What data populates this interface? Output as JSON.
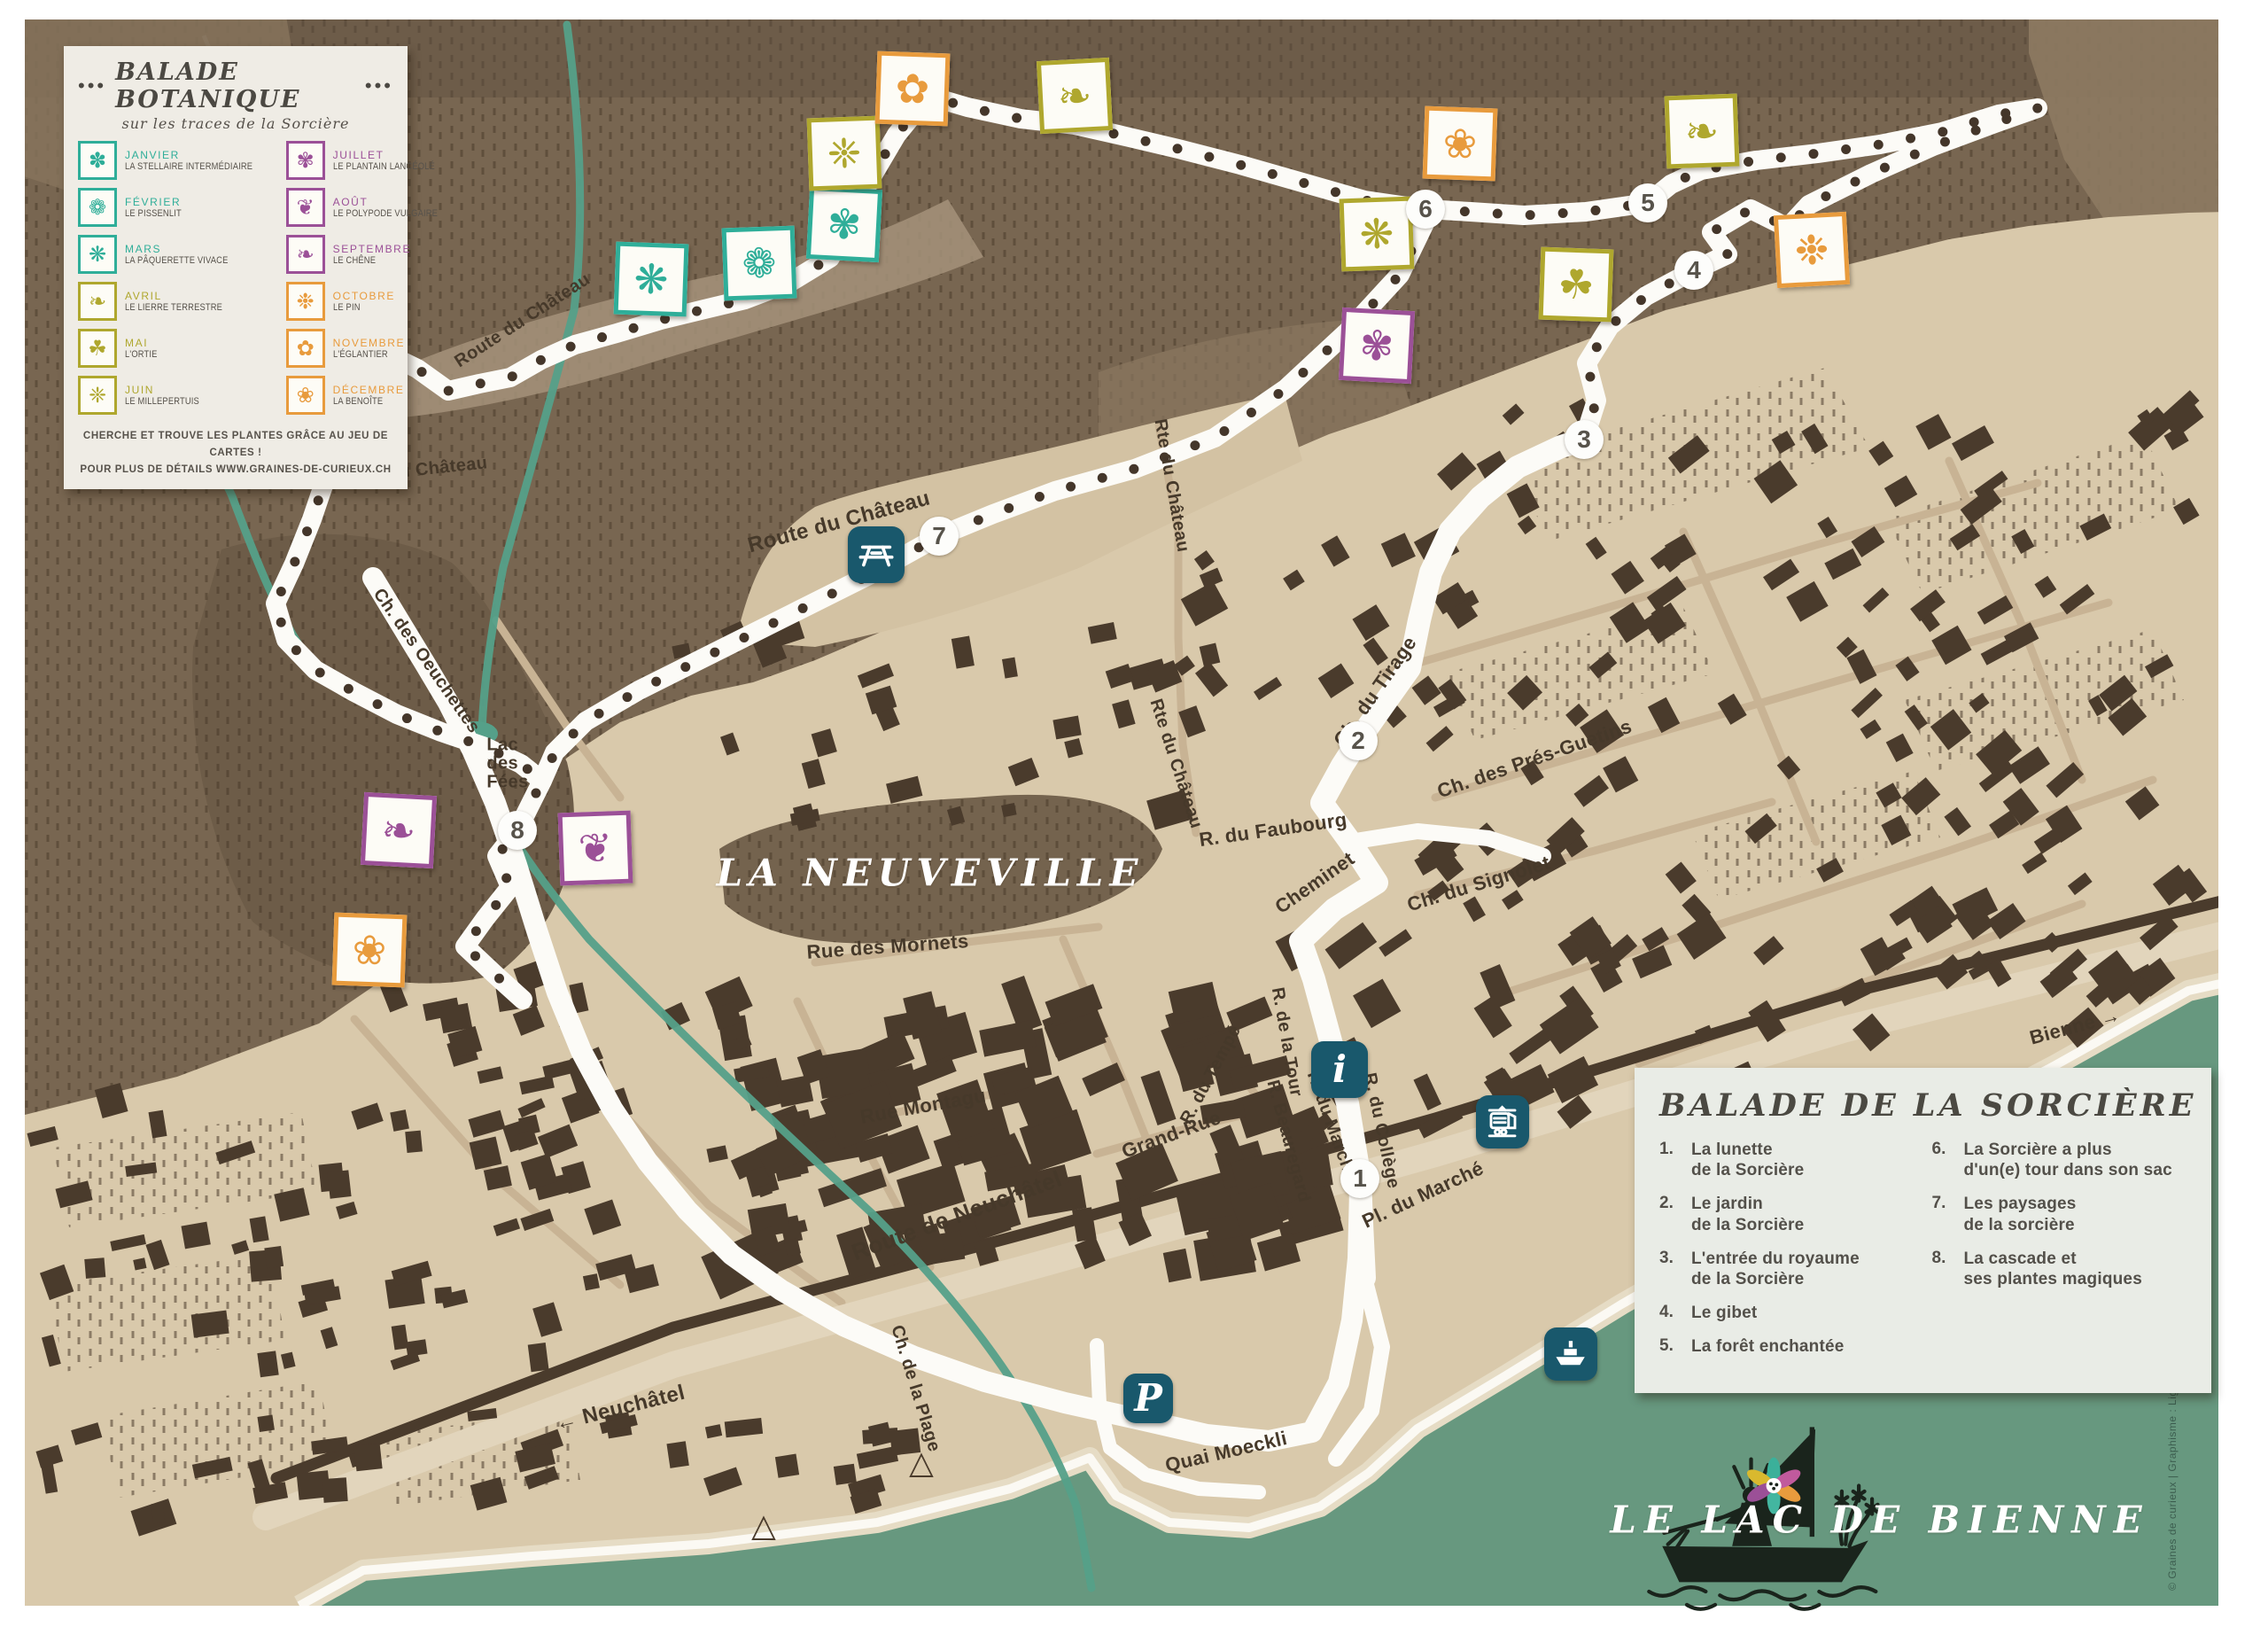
{
  "title_card": {
    "dots": "•••",
    "title": "BALADE BOTANIQUE",
    "subtitle": "sur les traces de la Sorcière",
    "months": [
      {
        "month": "JANVIER",
        "plant": "LA STELLAIRE INTERMÉDIAIRE",
        "color": "teal",
        "glyph": "✽"
      },
      {
        "month": "FÉVRIER",
        "plant": "LE PISSENLIT",
        "color": "teal",
        "glyph": "❁"
      },
      {
        "month": "MARS",
        "plant": "LA PÂQUERETTE VIVACE",
        "color": "teal",
        "glyph": "❋"
      },
      {
        "month": "AVRIL",
        "plant": "LE LIERRE TERRESTRE",
        "color": "olive",
        "glyph": "❧"
      },
      {
        "month": "MAI",
        "plant": "L'ORTIE",
        "color": "olive",
        "glyph": "☘"
      },
      {
        "month": "JUIN",
        "plant": "LE MILLEPERTUIS",
        "color": "olive",
        "glyph": "❈"
      },
      {
        "month": "JUILLET",
        "plant": "LE PLANTAIN LANCÉOLÉ",
        "color": "purple",
        "glyph": "✾"
      },
      {
        "month": "AOÛT",
        "plant": "LE POLYPODE VULGAIRE",
        "color": "purple",
        "glyph": "❦"
      },
      {
        "month": "SEPTEMBRE",
        "plant": "LE CHÊNE",
        "color": "purple",
        "glyph": "❧"
      },
      {
        "month": "OCTOBRE",
        "plant": "LE PIN",
        "color": "orange",
        "glyph": "❉"
      },
      {
        "month": "NOVEMBRE",
        "plant": "L'ÉGLANTIER",
        "color": "orange",
        "glyph": "✿"
      },
      {
        "month": "DÉCEMBRE",
        "plant": "LA BENOÎTE",
        "color": "orange",
        "glyph": "❀"
      }
    ],
    "note_line1": "CHERCHE ET TROUVE LES PLANTES GRÂCE AU JEU DE CARTES !",
    "note_line2": "POUR PLUS DE DÉTAILS WWW.GRAINES-DE-CURIEUX.CH"
  },
  "sorciere_card": {
    "title": "BALADE DE LA SORCIÈRE",
    "items": [
      {
        "num": "1.",
        "text": "La lunette\nde la Sorcière"
      },
      {
        "num": "2.",
        "text": "Le jardin\nde la Sorcière"
      },
      {
        "num": "3.",
        "text": "L'entrée du royaume\nde la Sorcière"
      },
      {
        "num": "4.",
        "text": "Le gibet"
      },
      {
        "num": "5.",
        "text": "La forêt enchantée"
      },
      {
        "num": "6.",
        "text": "La Sorcière a plus\nd'un(e) tour dans son sac"
      },
      {
        "num": "7.",
        "text": "Les paysages\nde la sorcière"
      },
      {
        "num": "8.",
        "text": "La cascade et\nses plantes magiques"
      }
    ]
  },
  "map": {
    "town_label": "LA NEUVEVILLE",
    "lake_label": "LE LAC DE BIENNE",
    "street_labels": [
      "Route du Château",
      "Route du Château",
      "Route du Château",
      "Rte du Château",
      "Rte du Château",
      "R. du Faubourg",
      "Cheminet",
      "Ch. du Tirage",
      "Ch. des Prés-Guetins",
      "Ch. du Signolet",
      "Rue des Mornets",
      "Rue Montagu",
      "Grand-Rue",
      "R. du Tempé",
      "R. de la Tour",
      "R. du Marché",
      "R. Beauregard",
      "R. du Collège",
      "Pl. du Marché",
      "Ch. des Oeuchettes",
      "Route de Neuchâtel",
      "← Neuchâtel",
      "Bienne →",
      "Ch. de la Plage",
      "Quai Moeckli",
      "Lac\ndes\nFées",
      "Ruisseau de Vaux"
    ],
    "waypoints": [
      "1",
      "2",
      "3",
      "4",
      "5",
      "6",
      "7",
      "8"
    ],
    "poi": {
      "info": "i",
      "parking": "P"
    },
    "symbols": {
      "campsite": "△"
    },
    "plant_stamps": [
      {
        "glyph": "✽",
        "color": "teal"
      },
      {
        "glyph": "❋",
        "color": "teal"
      },
      {
        "glyph": "❁",
        "color": "teal"
      },
      {
        "glyph": "✾",
        "color": "teal"
      },
      {
        "glyph": "❈",
        "color": "olive"
      },
      {
        "glyph": "✿",
        "color": "orange"
      },
      {
        "glyph": "❧",
        "color": "olive"
      },
      {
        "glyph": "❀",
        "color": "orange"
      },
      {
        "glyph": "❋",
        "color": "olive"
      },
      {
        "glyph": "✾",
        "color": "purple"
      },
      {
        "glyph": "❧",
        "color": "olive"
      },
      {
        "glyph": "☘",
        "color": "olive"
      },
      {
        "glyph": "❉",
        "color": "orange"
      },
      {
        "glyph": "❧",
        "color": "purple"
      },
      {
        "glyph": "❦",
        "color": "purple"
      },
      {
        "glyph": "❀",
        "color": "orange"
      }
    ],
    "credit": "© Graines de curieux | Graphisme : Ligne graphique Sàrl"
  },
  "colors": {
    "teal": "#2fae99",
    "olive": "#afa72e",
    "purple": "#9b5097",
    "orange": "#e89b3d",
    "poi_teal": "#19586c",
    "hill": "#786651",
    "town": "#d9c9ab",
    "building": "#4a3b2c",
    "lake": "#67987f",
    "trail": "#fcfbf7",
    "trail_dot": "#44362a",
    "stream": "#55a089"
  }
}
